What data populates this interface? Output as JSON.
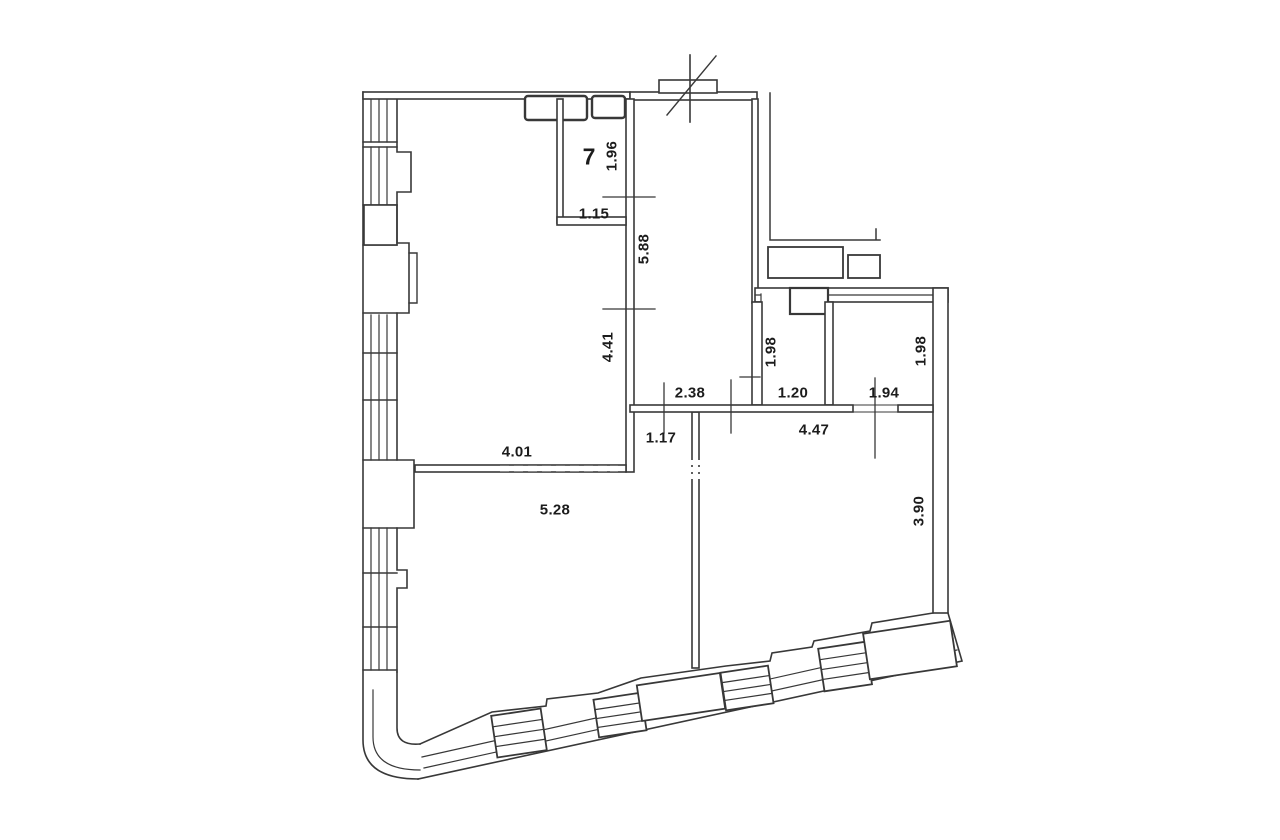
{
  "page": {
    "background": "#ffffff",
    "line_color": "#383838",
    "label_color": "#1c1c1c",
    "kind": "apartment floor plan drawing"
  },
  "plan": {
    "room_number": "7",
    "dims": {
      "alcove_height": "1.96",
      "alcove_width": "1.15",
      "kitchen_depth": "5.88",
      "left_room_height": "4.41",
      "hall_width": "2.38",
      "hall_inner_width": "1.17",
      "left_room_width": "4.01",
      "living_width": "5.28",
      "bath_left_height": "1.98",
      "bath_left_width": "1.20",
      "bath_right_width": "1.94",
      "corridor_width": "4.47",
      "bath_right_height": "1.98",
      "bedroom_height": "3.90"
    }
  }
}
